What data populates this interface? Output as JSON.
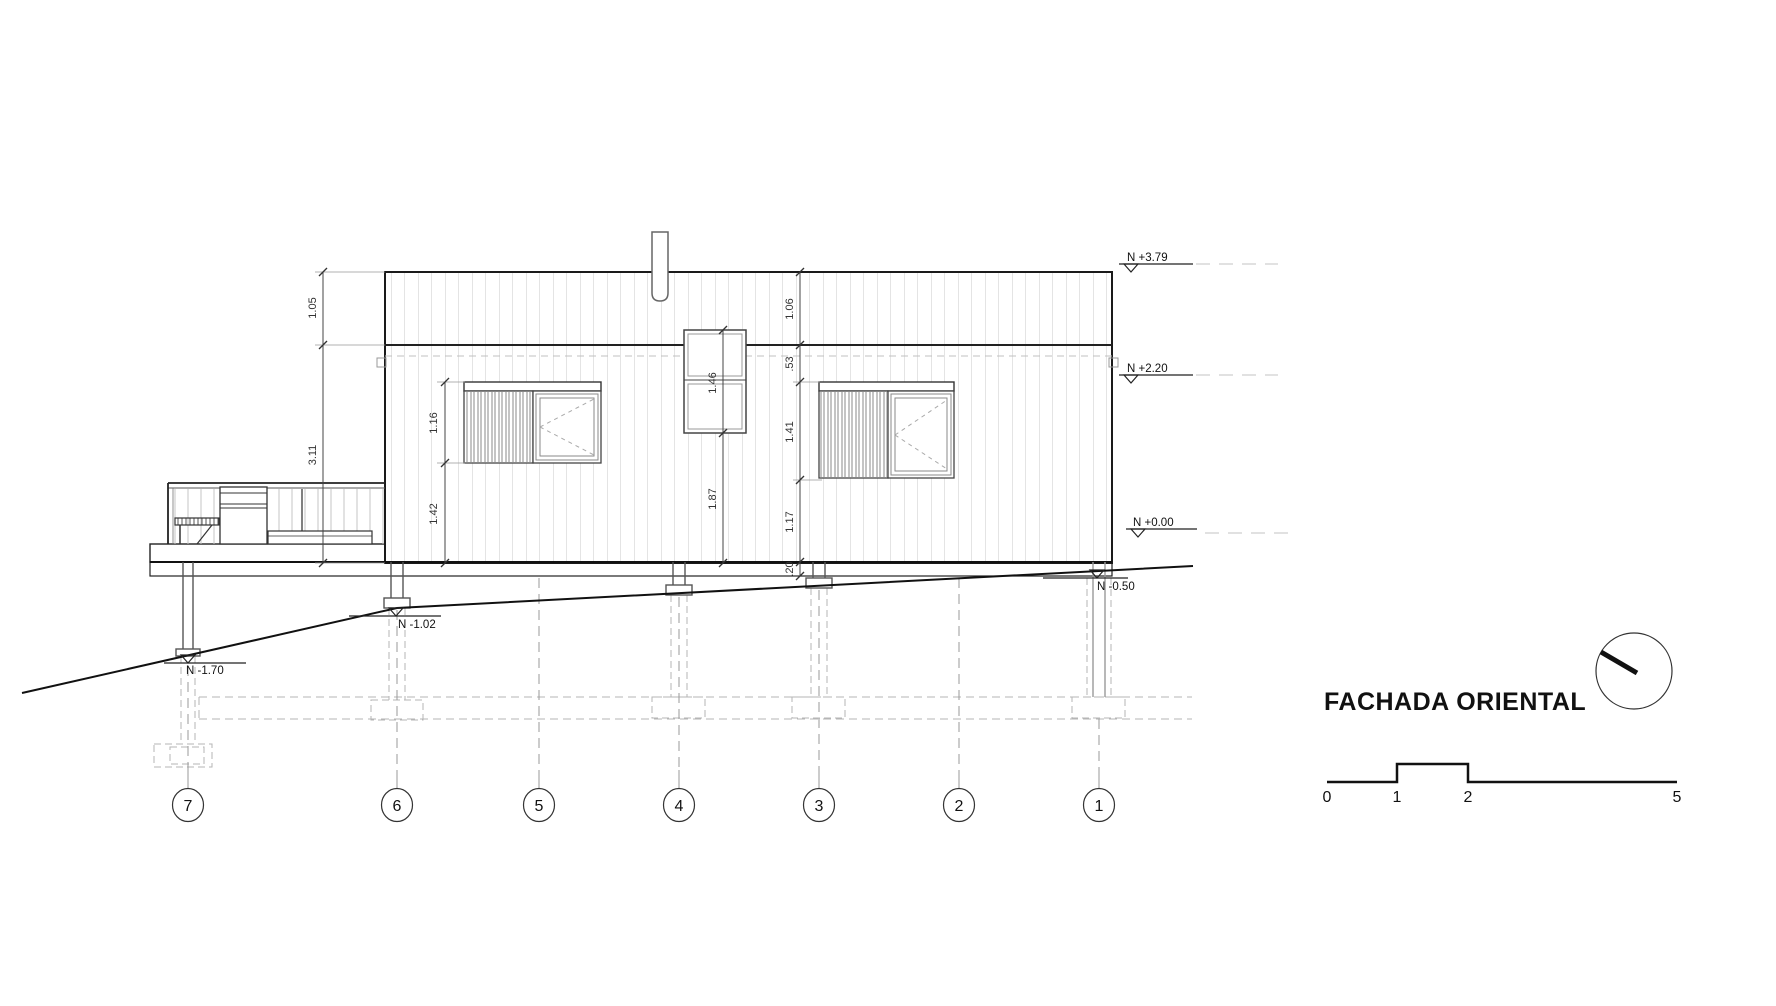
{
  "drawing": {
    "title": "FACHADA ORIENTAL",
    "levels": [
      {
        "id": "roof-top",
        "label": "N +3.79"
      },
      {
        "id": "eave",
        "label": "N +2.20"
      },
      {
        "id": "floor",
        "label": "N +0.00"
      },
      {
        "id": "grade-right",
        "label": "N -0.50"
      },
      {
        "id": "grade-mid",
        "label": "N -1.02"
      },
      {
        "id": "grade-left",
        "label": "N -1.70"
      }
    ],
    "dimensions": {
      "roof_band_left": "1.05",
      "wall_left": "3.11",
      "window_left_height": "1.16",
      "window_left_below": "1.42",
      "window_mid_height": "1.46",
      "window_mid_below": "1.87",
      "roof_band_right": "1.06",
      "band_to_header": ".53",
      "window_right_height": "1.41",
      "window_right_below": "1.17",
      "floor_band": ".20"
    },
    "grid_axes": [
      "7",
      "6",
      "5",
      "4",
      "3",
      "2",
      "1"
    ],
    "scale_bar": {
      "ticks": [
        "0",
        "1",
        "2",
        "5"
      ]
    },
    "colors": {
      "line": "#1a1a1a",
      "siding": "#c9c9c9",
      "foundation_dashed": "#b5b5b5",
      "background": "#ffffff"
    }
  }
}
